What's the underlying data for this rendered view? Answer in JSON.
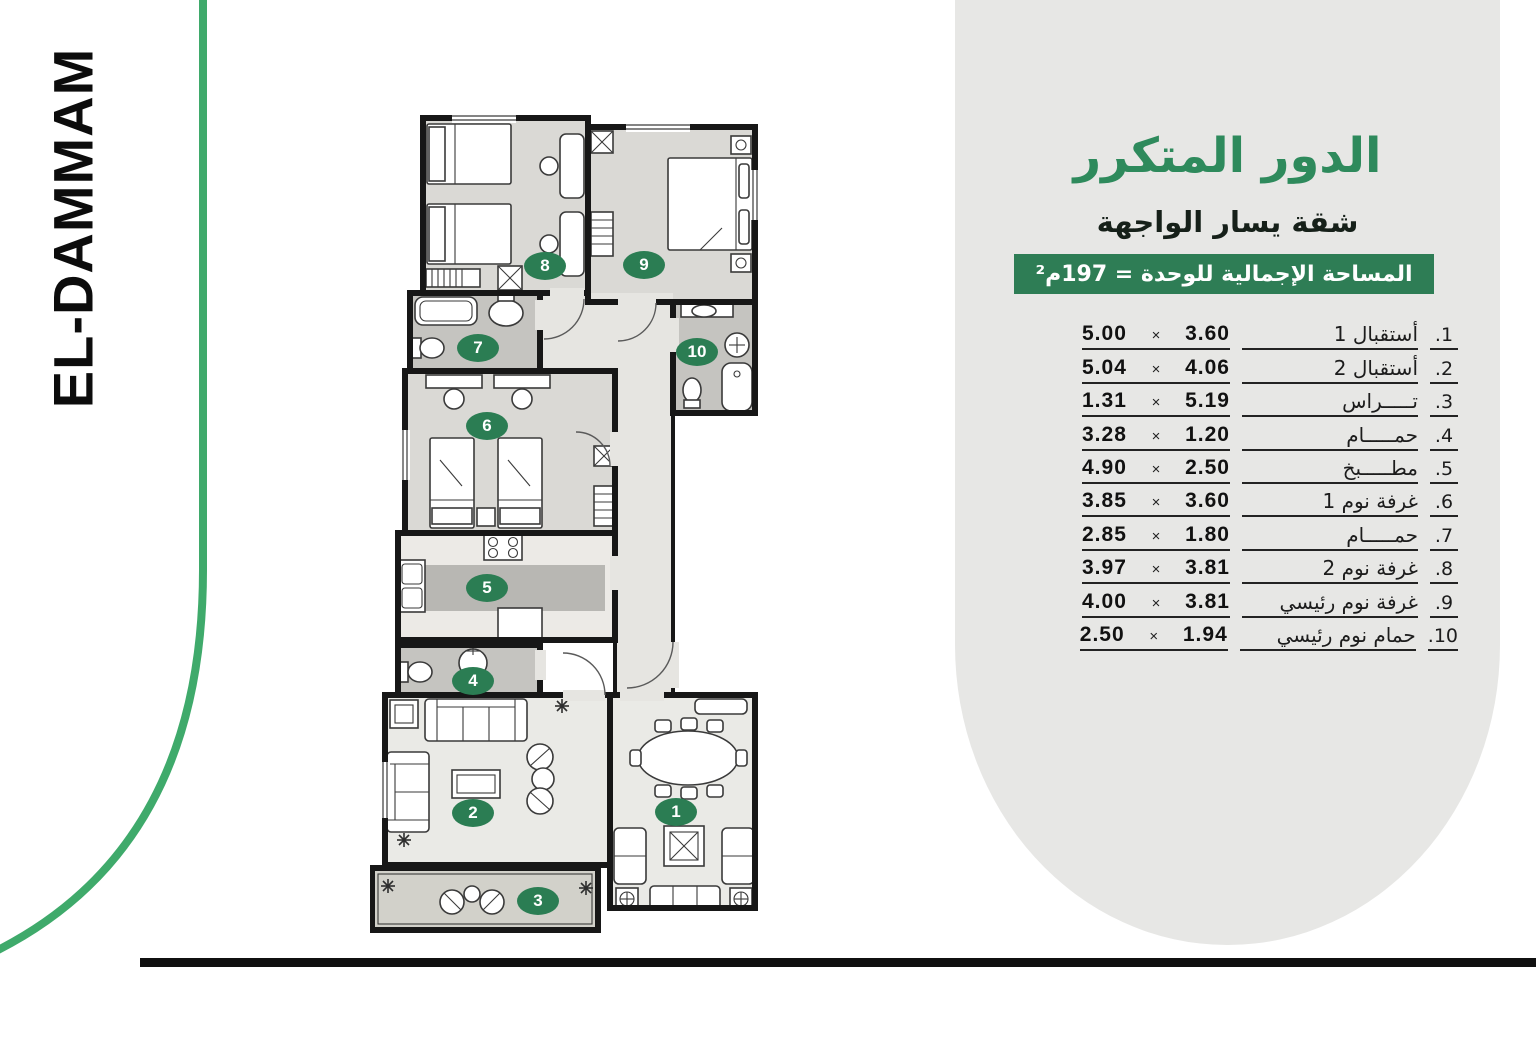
{
  "brand": {
    "name": "EL-DAMMAM"
  },
  "panel": {
    "title": "الدور المتكرر",
    "subtitle": "شقة يسار الواجهة",
    "area_banner": "المساحة الإجمالية للوحدة = 197م²",
    "times_symbol": "×",
    "rooms": [
      {
        "no": "1.",
        "name": "أستقبال 1",
        "w": "5.00",
        "h": "3.60"
      },
      {
        "no": "2.",
        "name": "أستقبال 2",
        "w": "5.04",
        "h": "4.06"
      },
      {
        "no": "3.",
        "name": "تـــــراس",
        "w": "1.31",
        "h": "5.19"
      },
      {
        "no": "4.",
        "name": "حمـــــام",
        "w": "3.28",
        "h": "1.20"
      },
      {
        "no": "5.",
        "name": "مطـــــبخ",
        "w": "4.90",
        "h": "2.50"
      },
      {
        "no": "6.",
        "name": "غرفة نوم 1",
        "w": "3.85",
        "h": "3.60"
      },
      {
        "no": "7.",
        "name": "حمـــــام",
        "w": "2.85",
        "h": "1.80"
      },
      {
        "no": "8.",
        "name": "غرفة نوم 2",
        "w": "3.97",
        "h": "3.81"
      },
      {
        "no": "9.",
        "name": "غرفة نوم رئيسي",
        "w": "4.00",
        "h": "3.81"
      },
      {
        "no": "10.",
        "name": "حمام نوم رئيسي",
        "w": "2.50",
        "h": "1.94"
      }
    ]
  },
  "floorplan": {
    "badges": [
      {
        "label": "1",
        "x": 676,
        "y": 812
      },
      {
        "label": "2",
        "x": 473,
        "y": 813
      },
      {
        "label": "3",
        "x": 538,
        "y": 901
      },
      {
        "label": "4",
        "x": 473,
        "y": 681
      },
      {
        "label": "5",
        "x": 487,
        "y": 588
      },
      {
        "label": "6",
        "x": 487,
        "y": 426
      },
      {
        "label": "7",
        "x": 478,
        "y": 348
      },
      {
        "label": "8",
        "x": 545,
        "y": 266
      },
      {
        "label": "9",
        "x": 644,
        "y": 265
      },
      {
        "label": "10",
        "x": 697,
        "y": 352
      }
    ]
  },
  "colors": {
    "green-title": "#2e8a5c",
    "green-banner": "#2e7d55",
    "green-badge": "#2b7d53",
    "green-line": "#3faa6b",
    "panel-gray": "#e7e7e5"
  }
}
